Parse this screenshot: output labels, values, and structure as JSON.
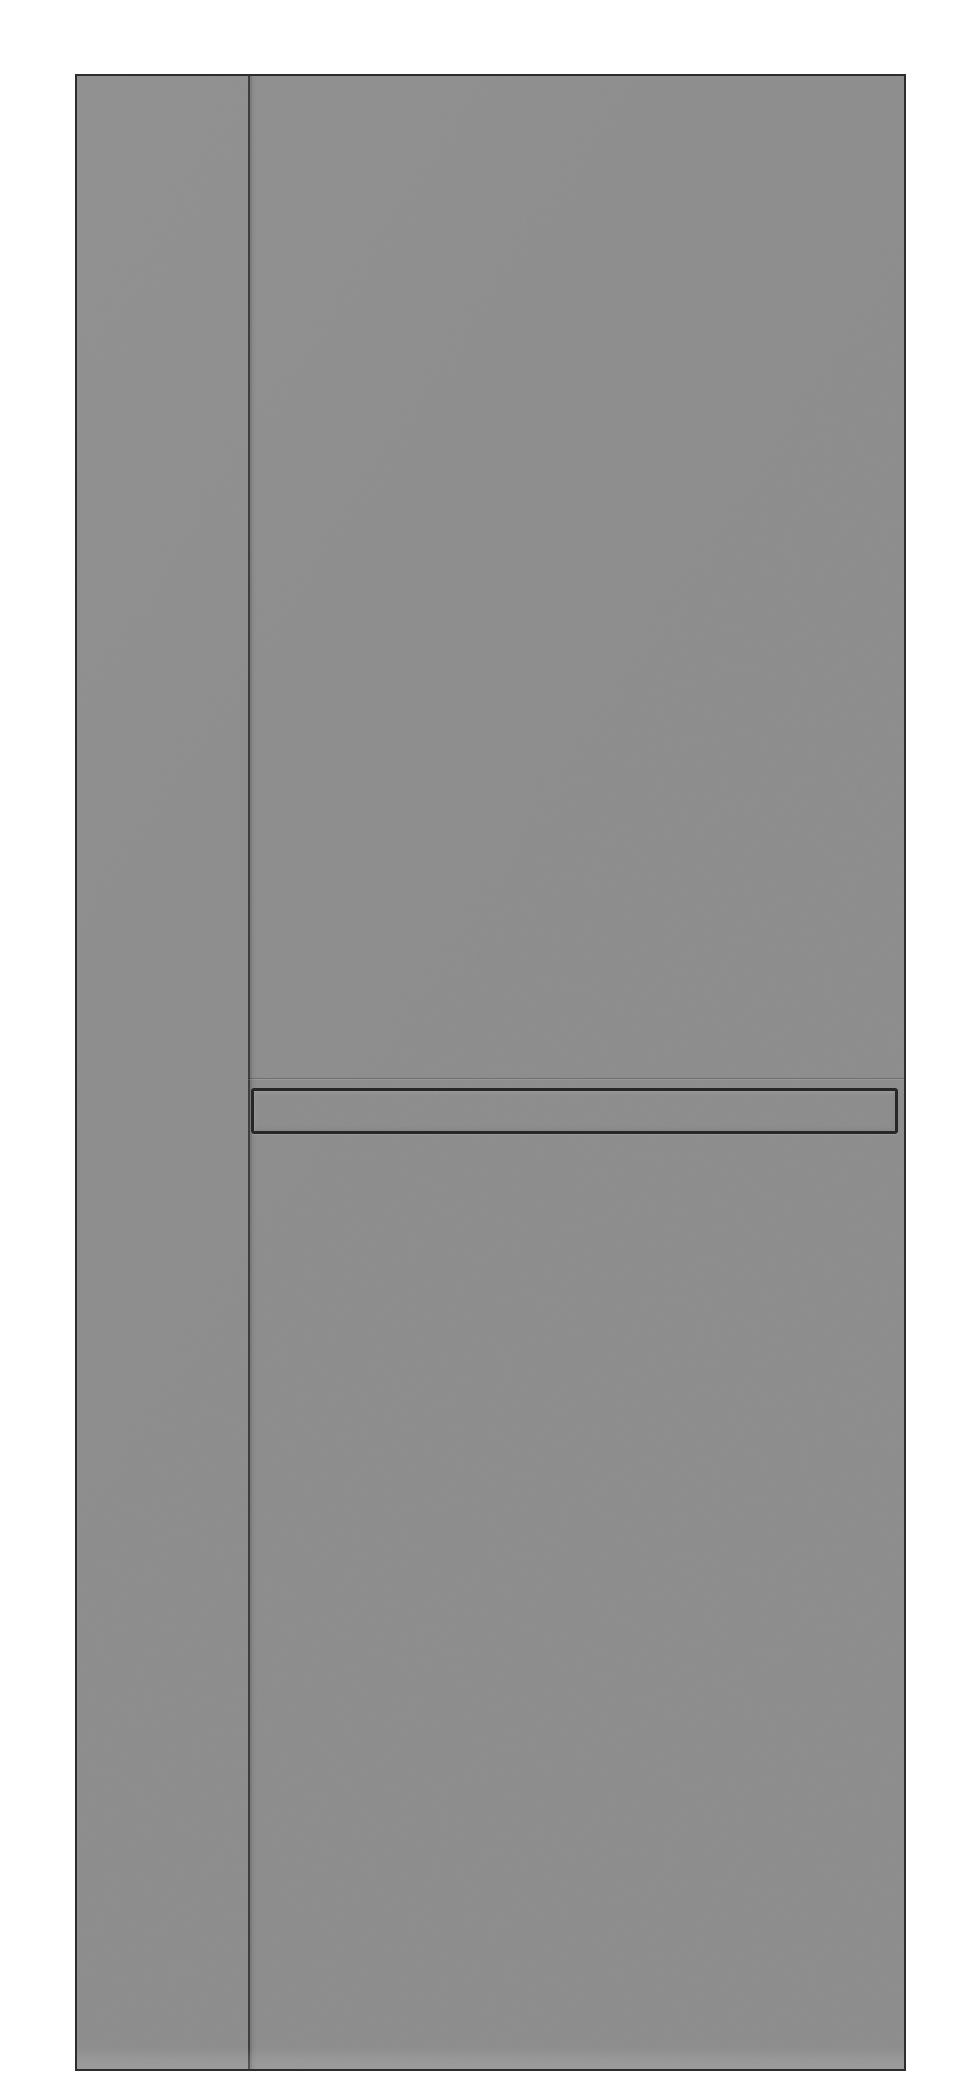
{
  "scene": {
    "subject": "Gray flat interior door slab shown front-on, isolated on a white background, with a thin vertical groove near the left side and a long recessed horizontal handle strip",
    "elements": {
      "door_panel": "full-height matte gray slab with thin dark outline",
      "vertical_groove": "thin dark vertical groove running the full height near the left edge",
      "horizontal_seam": "faint horizontal seam line just above the handle, spanning from the groove to the right edge",
      "recessed_handle": "long thin rectangular recessed handle strip outlined in dark gray",
      "floor_reflection": "subtle lighter band along the bottom of the slab"
    }
  },
  "colors": {
    "background": "#ffffff",
    "door-fill": "#8c8c8c",
    "door-fill-light": "#909090",
    "door-edge": "#2c2c2c",
    "groove-dark": "#3a3a3a",
    "handle-border": "#232323"
  }
}
